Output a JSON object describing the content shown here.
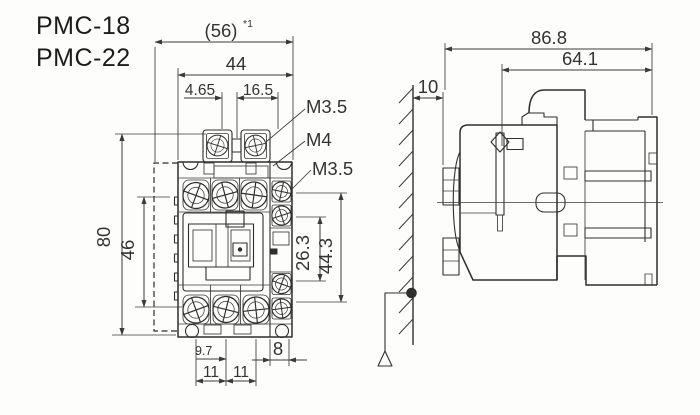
{
  "title": {
    "model_1": "PMC-18",
    "model_2": "PMC-22"
  },
  "front_view": {
    "dim_overall_width": "(56)",
    "dim_overall_width_note": "*1",
    "dim_body_width": "44",
    "dim_coil_terminal_offset": "4.65",
    "dim_coil_terminal_pitch": "16.5",
    "label_coil_screw": "M3.5",
    "label_main_screw": "M4",
    "label_aux_screw": "M3.5",
    "dim_height": "80",
    "dim_mounting_pitch": "46",
    "dim_aux_block_inner": "26.3",
    "dim_aux_block_outer": "44.3",
    "dim_bottom_offset": "9.7",
    "dim_pole_pitch_a": "11",
    "dim_pole_pitch_b": "11",
    "dim_aux_block_width": "8"
  },
  "side_view": {
    "dim_depth_total": "86.8",
    "dim_depth_body": "64.1",
    "dim_wall_gap": "10"
  },
  "colors": {
    "line": "#2e2e2e",
    "dimension": "#3a3a3a",
    "background": "#fdfdfc"
  }
}
